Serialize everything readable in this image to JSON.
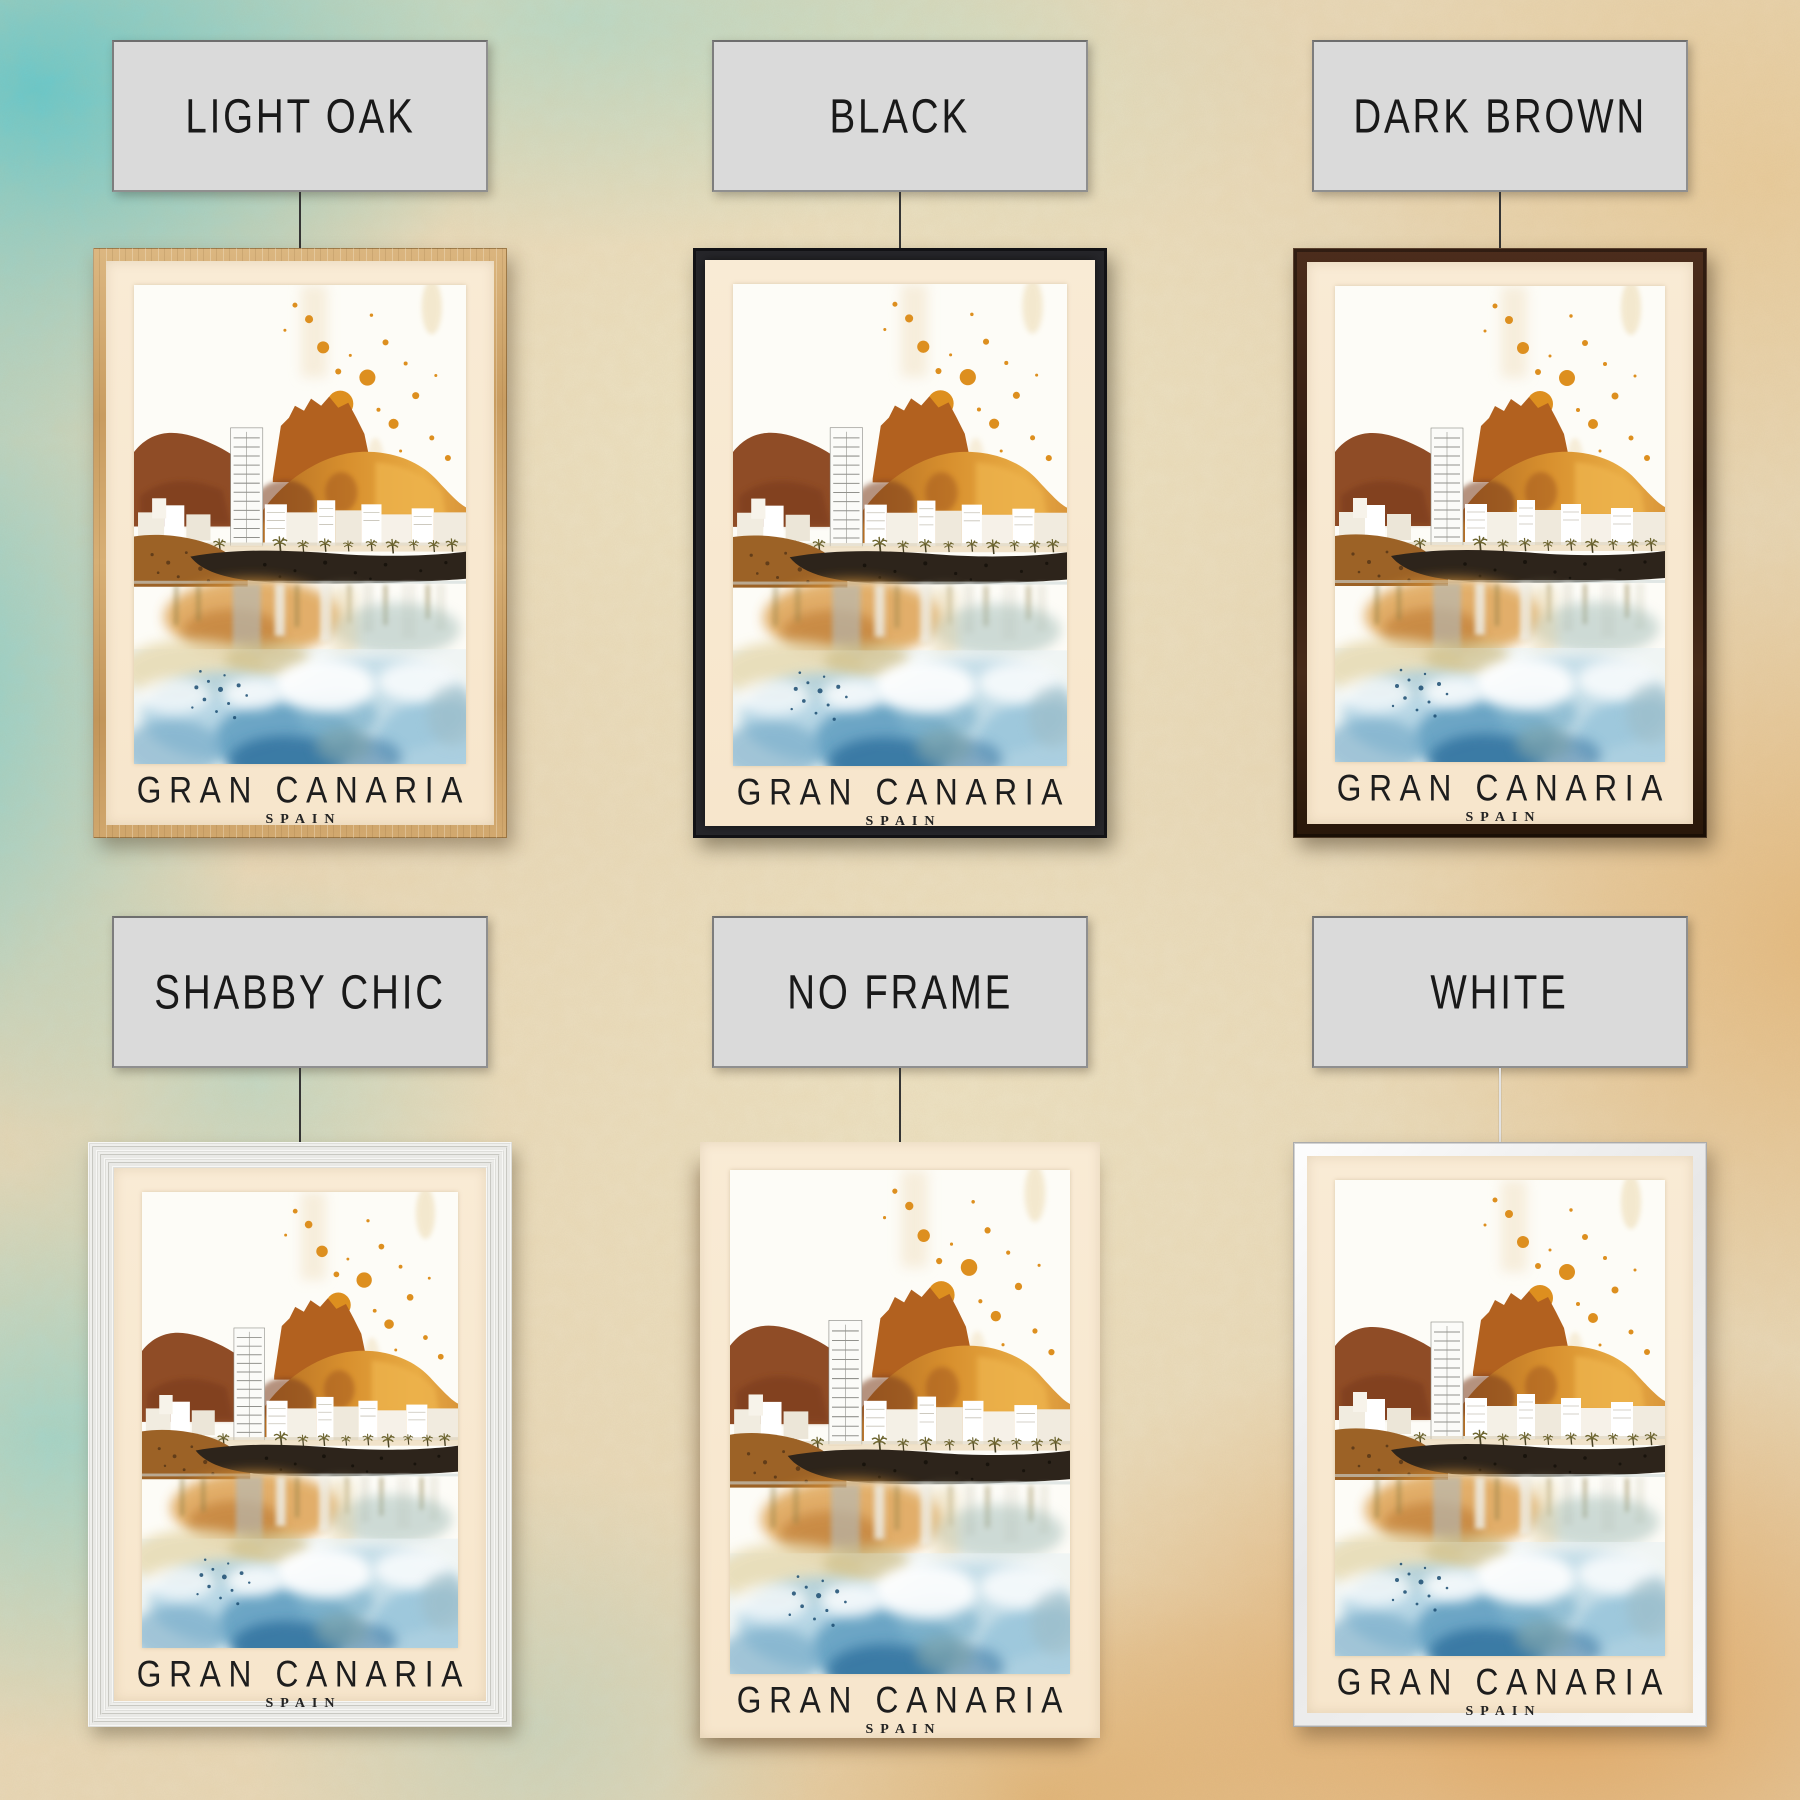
{
  "poster": {
    "title": "GRAN CANARIA",
    "subtitle": "SPAIN"
  },
  "variants": [
    {
      "id": "light-oak",
      "label": "LIGHT OAK",
      "frame_color": "#c9a062"
    },
    {
      "id": "black",
      "label": "BLACK",
      "frame_color": "#26262a"
    },
    {
      "id": "dark-brown",
      "label": "DARK BROWN",
      "frame_color": "#3b2213"
    },
    {
      "id": "shabby-chic",
      "label": "SHABBY CHIC",
      "frame_color": "#ececea"
    },
    {
      "id": "no-frame",
      "label": "NO FRAME",
      "frame_color": "none"
    },
    {
      "id": "white",
      "label": "WHITE",
      "frame_color": "#f4f4f4"
    }
  ],
  "label_style": {
    "bg": "#dadada",
    "border": "#8f8f8f",
    "text_color": "#191919"
  },
  "artwork": {
    "subject": "Watercolor travel poster of Gran Canaria: orange rocky mountain with castle-like peak, white seafront buildings and tall tower, palm-lined promenade, dark volcanic shore, mirrored reflections dissolving into blue watercolor washes with orange paint splatters",
    "palette": {
      "splatter_orange": "#dd8f1f",
      "mountain_orange": "#d8902e",
      "mountain_brown": "#8f4c26",
      "rock_dark": "#2d241b",
      "water_deep_blue": "#2f6f9d",
      "water_light_blue": "#aed2e3",
      "mat_cream": "#f8e8d0"
    }
  },
  "wall": {
    "base": "#e9d9b9",
    "teal_accent": "#6ec9cd",
    "orange_accent": "#df923e"
  }
}
